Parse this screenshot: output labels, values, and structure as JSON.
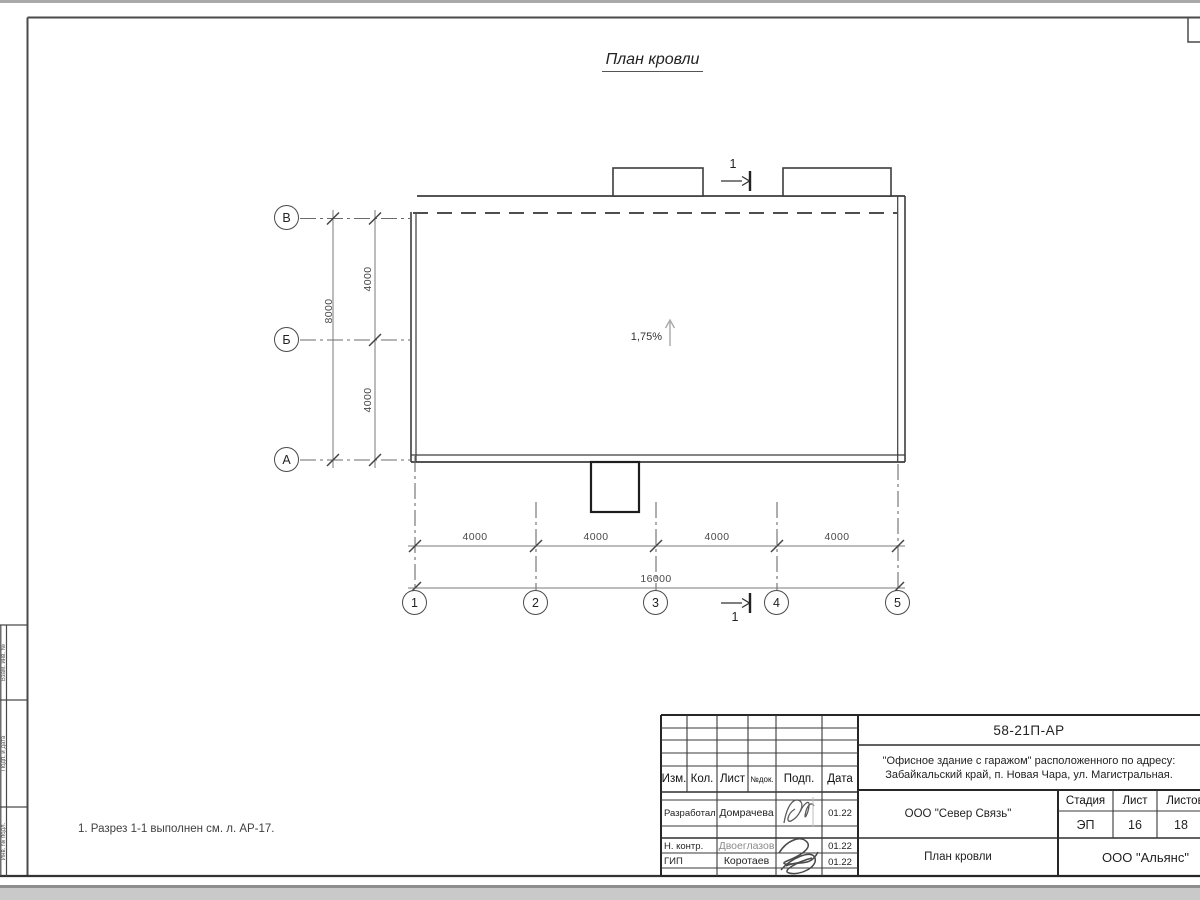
{
  "drawing": {
    "title": "План кровли",
    "slope": "1,75%",
    "section_mark": "1",
    "axes_rows": [
      "В",
      "Б",
      "А"
    ],
    "axes_cols": [
      "1",
      "2",
      "3",
      "4",
      "5"
    ],
    "dims_left_inner": [
      "4000",
      "4000"
    ],
    "dim_left_outer": "8000",
    "dims_bottom_inner": [
      "4000",
      "4000",
      "4000",
      "4000"
    ],
    "dim_bottom_total": "16000"
  },
  "note": "1. Разрез 1-1 выполнен см. л. АР-17.",
  "title_block": {
    "doc_number": "58-21П-АР",
    "project_address_line1": "\"Офисное здание с гаражом\" расположенного по адресу:",
    "project_address_line2": "Забайкальский край, п. Новая Чара, ул. Магистральная.",
    "rev_header": [
      "Изм.",
      "Кол.",
      "Лист",
      "№док.",
      "Подп.",
      "Дата"
    ],
    "signers": [
      {
        "role": "Разработал",
        "name": "Домрачева",
        "date": "01.22"
      },
      {
        "role": "Н. контр.",
        "name": "Двоеглазов",
        "date": "01.22"
      },
      {
        "role": "ГИП",
        "name": "Коротаев",
        "date": "01.22"
      }
    ],
    "contractor": "ООО \"Север Связь\"",
    "sheet_name": "План кровли",
    "company": "ООО \"Альянс\"",
    "stage_label": "Стадия",
    "sheet_label": "Лист",
    "sheets_label": "Листов",
    "stage": "ЭП",
    "sheet_no": "16",
    "sheets_total": "18"
  },
  "frame_side_labels": [
    "Взам. инв. №",
    "Подп. и дата",
    "Инв. № подл."
  ]
}
